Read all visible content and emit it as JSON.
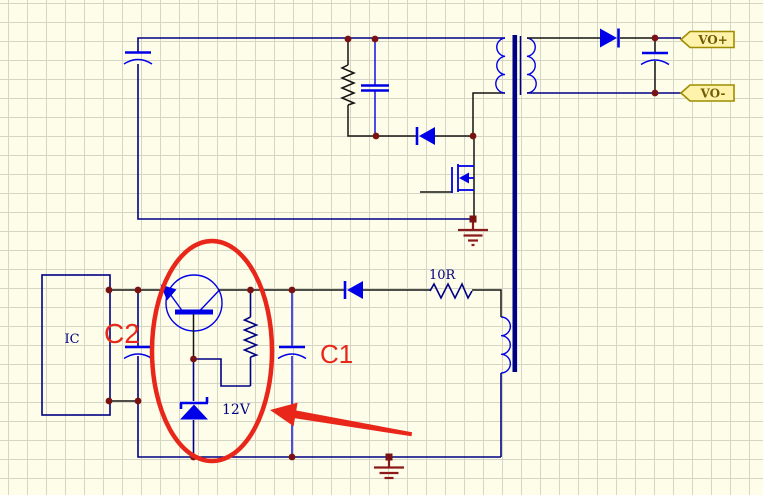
{
  "schematic": {
    "kind": "flyback-power-supply-circuit",
    "labels": {
      "ic": "IC",
      "series_resistor": "10R",
      "zener_voltage": "12V"
    },
    "annotations": {
      "c1": "C1",
      "c2": "C2"
    },
    "ports": {
      "positive": "VO+",
      "negative": "VO-"
    },
    "colors": {
      "wire": "#000084",
      "wire_dark": "#141414",
      "component": "#0000e8",
      "junction": "#7a1212",
      "ground": "#8b1a1a",
      "annotation": "#e8271a",
      "label": "#000080",
      "port_fill": "#fff2aa",
      "port_border": "#a08c00",
      "port_text": "#6f5b00",
      "background": "#fdfde9",
      "grid": "#d5d5c5"
    }
  }
}
